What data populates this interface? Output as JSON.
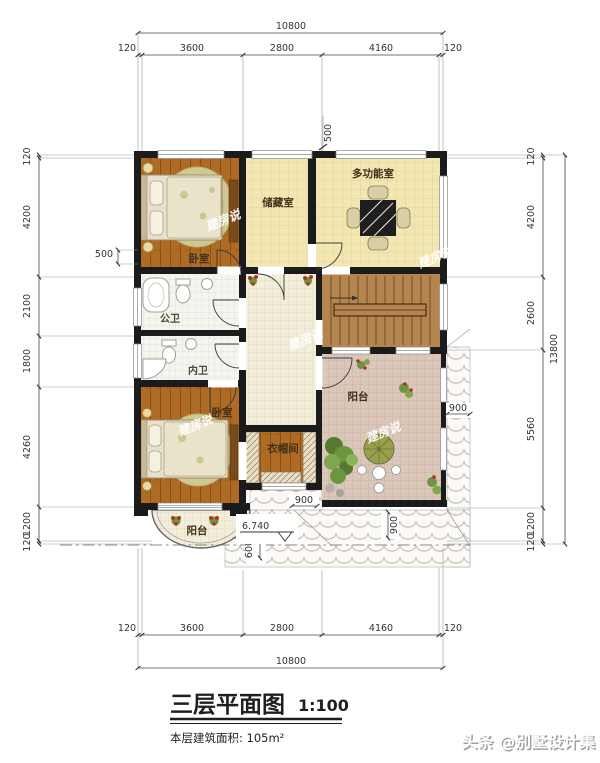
{
  "title": {
    "name": "三层平面图",
    "scale": "1:100",
    "area": "本层建筑面积: 105m²"
  },
  "footer": {
    "watermark": "头条 @别墅设计集"
  },
  "watermark": {
    "text": "建房说"
  },
  "rooms": {
    "bedroom1": "卧室",
    "storage": "储藏室",
    "multi": "多功能室",
    "public_bath": "公卫",
    "ensuite_bath": "内卫",
    "bedroom2": "卧室",
    "cloak": "衣帽间",
    "balcony_right": "阳台",
    "balcony_front": "阳台"
  },
  "dims": {
    "top": {
      "total": "10800",
      "segs": [
        "120",
        "3600",
        "2800",
        "4160",
        "120"
      ]
    },
    "bottom": {
      "total": "10800",
      "segs": [
        "120",
        "3600",
        "2800",
        "4160",
        "120"
      ]
    },
    "left": {
      "segs": [
        "120",
        "4200",
        "2100",
        "1800",
        "4260",
        "1200",
        "120"
      ],
      "offset": "500"
    },
    "right": {
      "total": "13800",
      "segs": [
        "120",
        "4200",
        "2600",
        "5560",
        "1200",
        "120"
      ]
    },
    "inner": {
      "top_offset": "500",
      "eave_right": "900",
      "eave_bottom": "900",
      "eave_corner": "900",
      "eave_depth": "600",
      "elevation": "6.740"
    }
  },
  "colors": {
    "wall": "#1b1b1b"
  }
}
